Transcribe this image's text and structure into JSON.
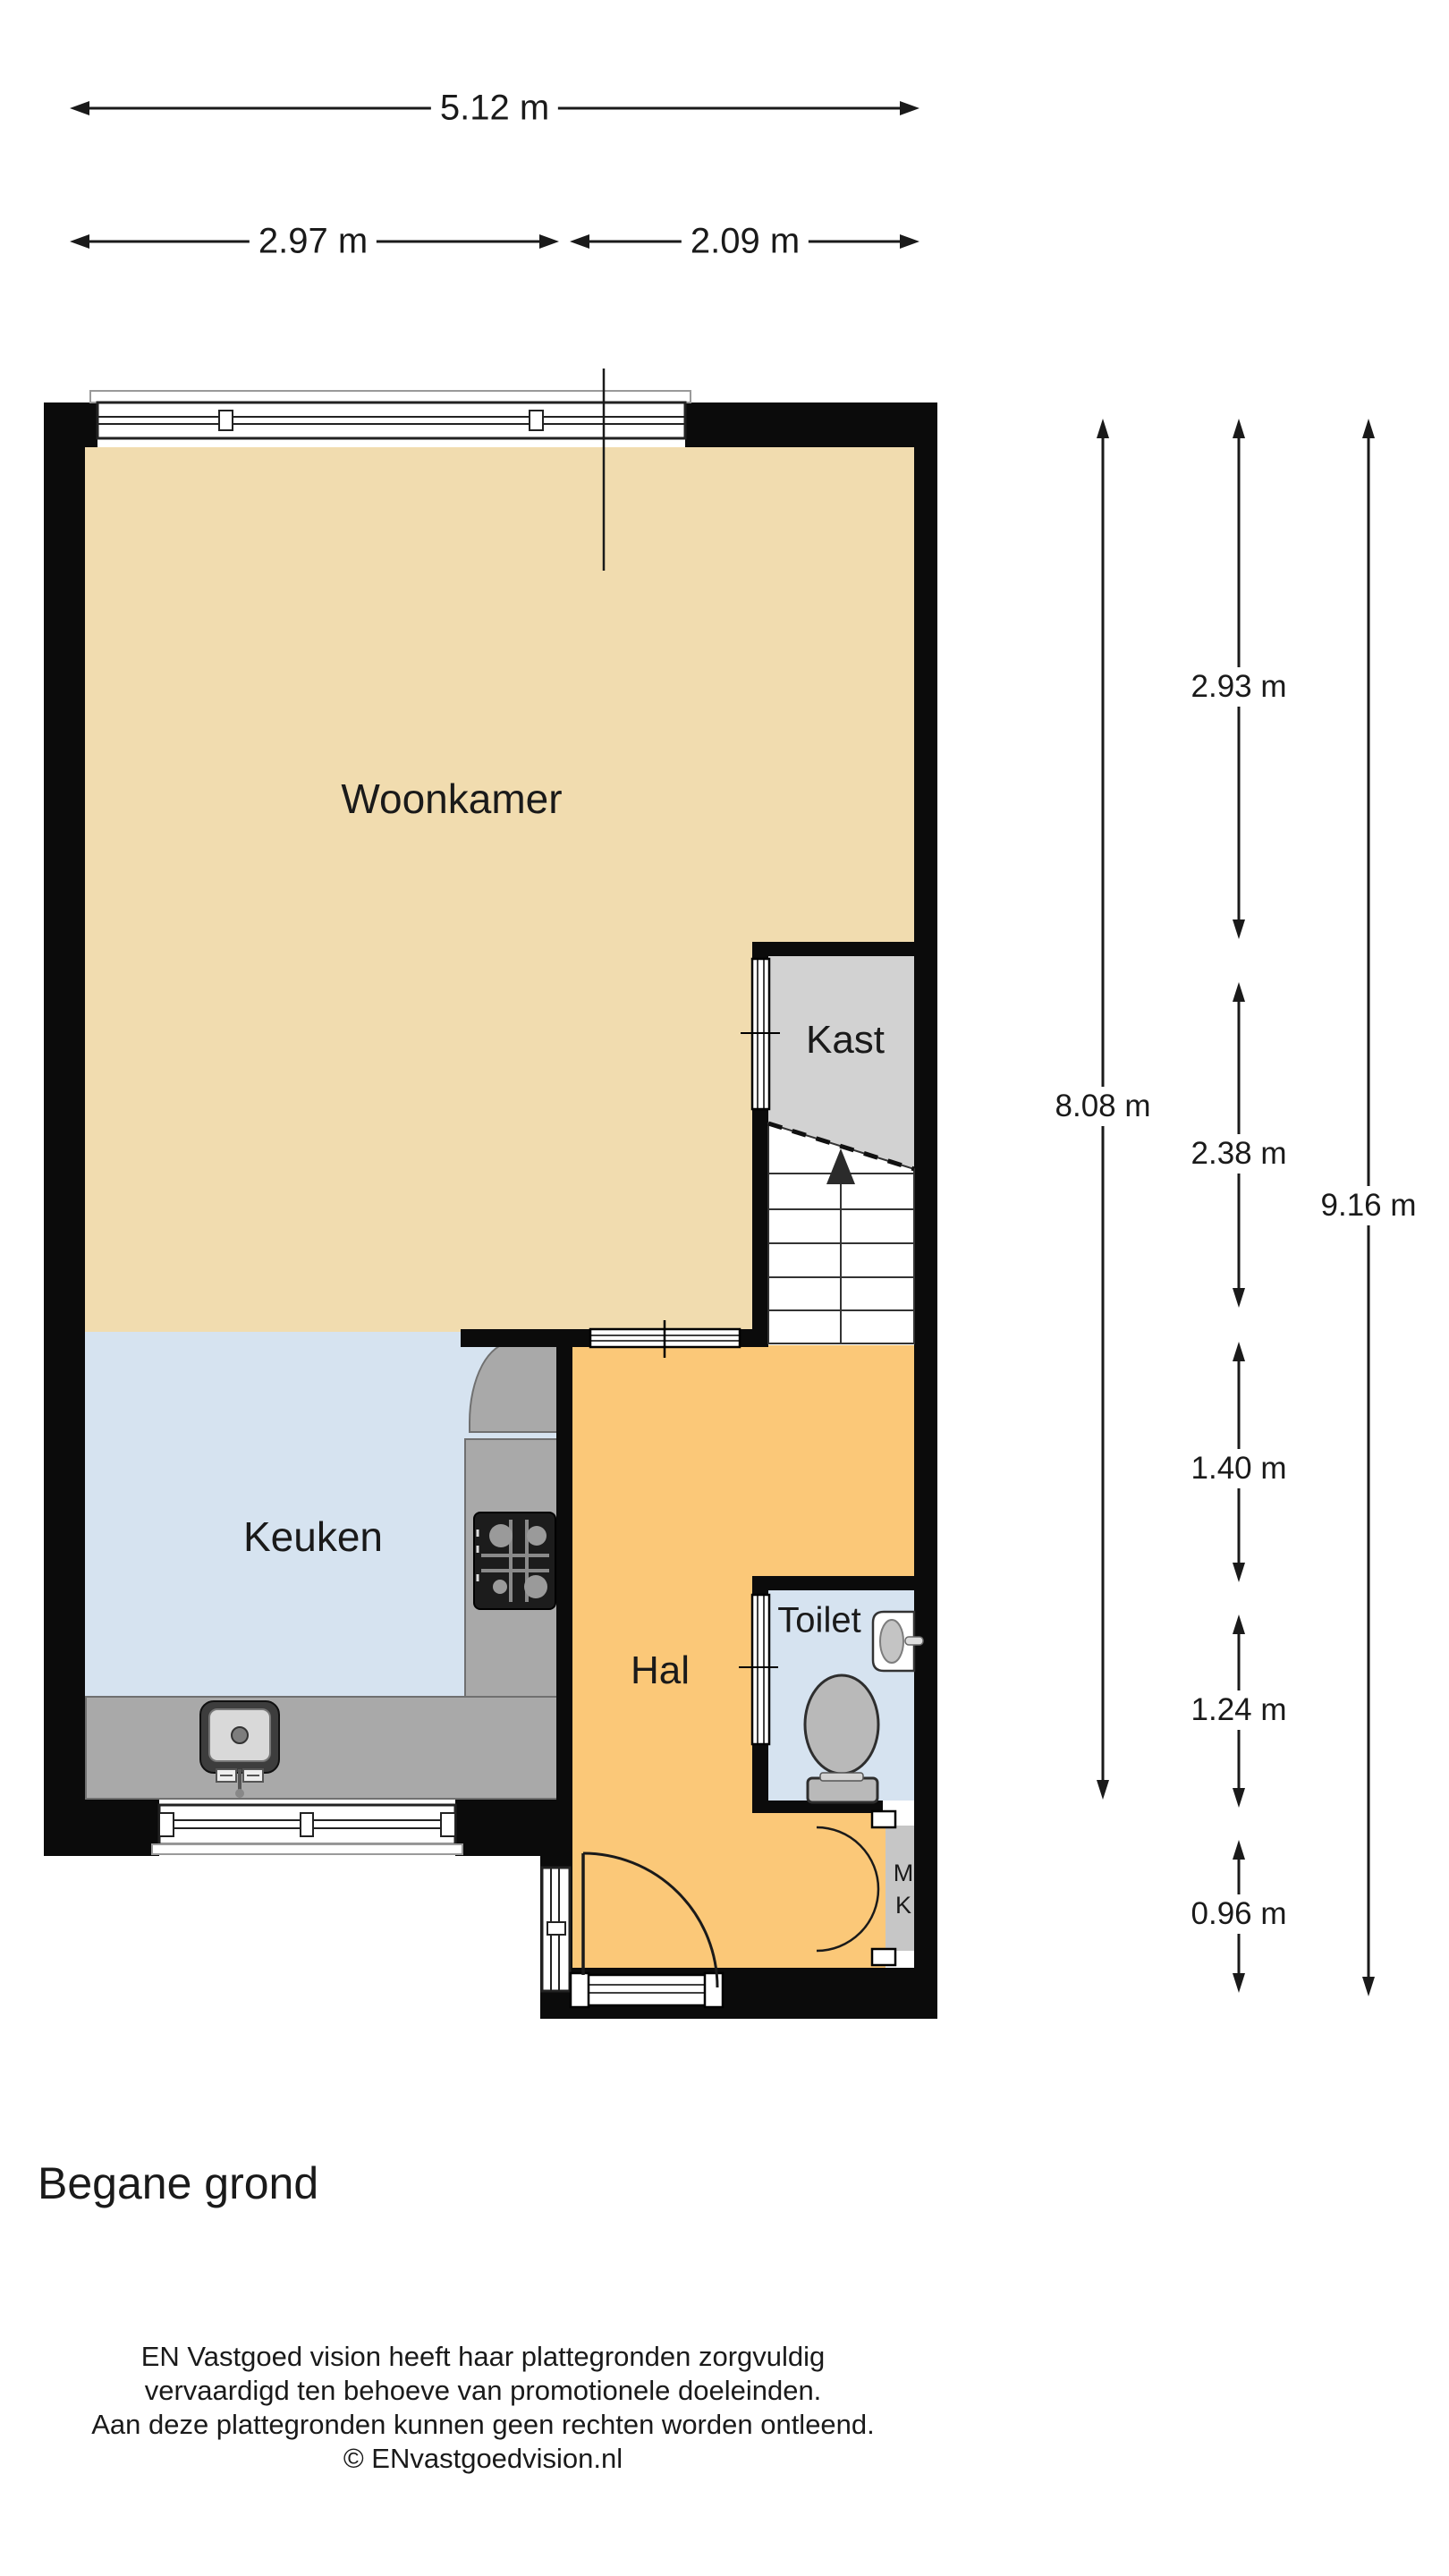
{
  "title": "Begane grond",
  "rooms": {
    "woonkamer": "Woonkamer",
    "kast": "Kast",
    "keuken": "Keuken",
    "hal": "Hal",
    "toilet": "Toilet",
    "meterkast_line1": "M",
    "meterkast_line2": "K"
  },
  "dimensions": {
    "top_total": "5.12 m",
    "top_left": "2.97 m",
    "top_right": "2.09 m",
    "left_column": "8.08 m",
    "segments": [
      "2.93 m",
      "2.38 m",
      "1.40 m",
      "1.24 m",
      "0.96 m"
    ],
    "right_column": "9.16 m"
  },
  "footer": {
    "line1": "EN Vastgoed vision heeft haar plattegronden zorgvuldig",
    "line2": "vervaardigd ten behoeve van promotionele doeleinden.",
    "line3": "Aan deze plattegronden kunnen geen rechten worden ontleend.",
    "line4": "© ENvastgoedvision.nl"
  },
  "colors": {
    "wall": "#0B0B0B",
    "woonkamer": "#F1DCAF",
    "keuken": "#D6E3F0",
    "hal": "#FBC878",
    "kast": "#D2D2D2",
    "counter": "#A9A9A9",
    "counterline": "#707070",
    "mk": "#C6C6C6",
    "ink": "#1A1A1A",
    "fixture": "#B9B9B9"
  }
}
